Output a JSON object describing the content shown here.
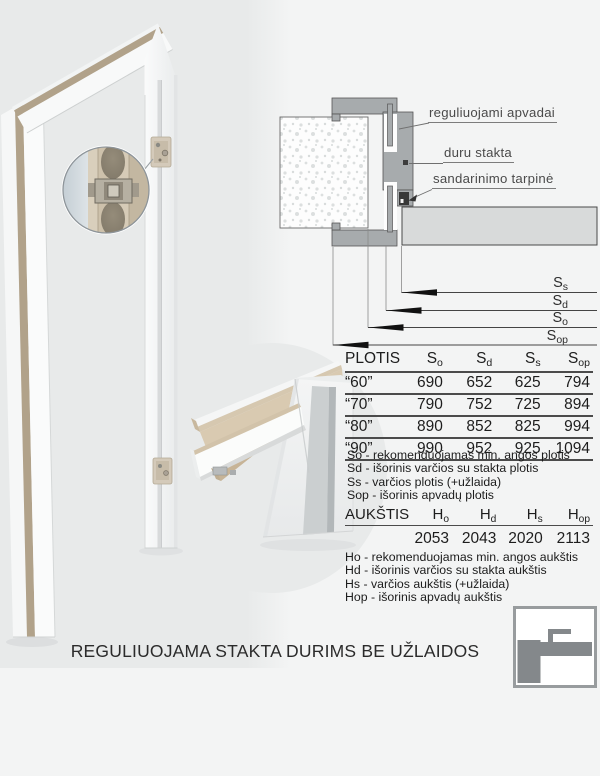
{
  "page_title": "REGULIUOJAMA STAKTA DURIMS BE UŽLAIDOS",
  "drawing": {
    "label_apvadai": "reguliuojami apvadai",
    "label_stakta": "duru stakta",
    "label_tarpine": "sandarinimo tarpinė",
    "dim_labels": [
      {
        "base": "S",
        "sub": "s"
      },
      {
        "base": "S",
        "sub": "d"
      },
      {
        "base": "S",
        "sub": "o"
      },
      {
        "base": "S",
        "sub": "op"
      }
    ]
  },
  "plotis_table": {
    "title": "PLOTIS",
    "columns": [
      {
        "base": "S",
        "sub": "o"
      },
      {
        "base": "S",
        "sub": "d"
      },
      {
        "base": "S",
        "sub": "s"
      },
      {
        "base": "S",
        "sub": "op"
      }
    ],
    "rows": [
      {
        "size": "“60”",
        "values": [
          "690",
          "652",
          "625",
          "794"
        ]
      },
      {
        "size": "“70”",
        "values": [
          "790",
          "752",
          "725",
          "894"
        ]
      },
      {
        "size": "“80”",
        "values": [
          "890",
          "852",
          "825",
          "994"
        ]
      },
      {
        "size": "“90”",
        "values": [
          "990",
          "952",
          "925",
          "1094"
        ]
      }
    ],
    "legend": [
      "So - rekomenduojamas min. angos plotis",
      "Sd - išorinis varčios su stakta plotis",
      "Ss - varčios plotis (+užlaida)",
      "Sop - išorinis apvadų plotis"
    ]
  },
  "aukstis_table": {
    "title": "AUKŠTIS",
    "columns": [
      {
        "base": "H",
        "sub": "o"
      },
      {
        "base": "H",
        "sub": "d"
      },
      {
        "base": "H",
        "sub": "s"
      },
      {
        "base": "H",
        "sub": "op"
      }
    ],
    "values": [
      "2053",
      "2043",
      "2020",
      "2113"
    ],
    "legend": [
      "Ho - rekomenduojamas min. angos aukštis",
      "Hd - išorinis varčios su stakta aukštis",
      "Hs - varčios aukštis (+užlaida)",
      "Hop - išorinis apvadų aukštis"
    ]
  },
  "colors": {
    "frame_gray": "#a7abad",
    "leaf_gray": "#d8dada",
    "wood_tan": "#b1a28a",
    "seal_black": "#383838",
    "logo_gray": "#84888b"
  }
}
